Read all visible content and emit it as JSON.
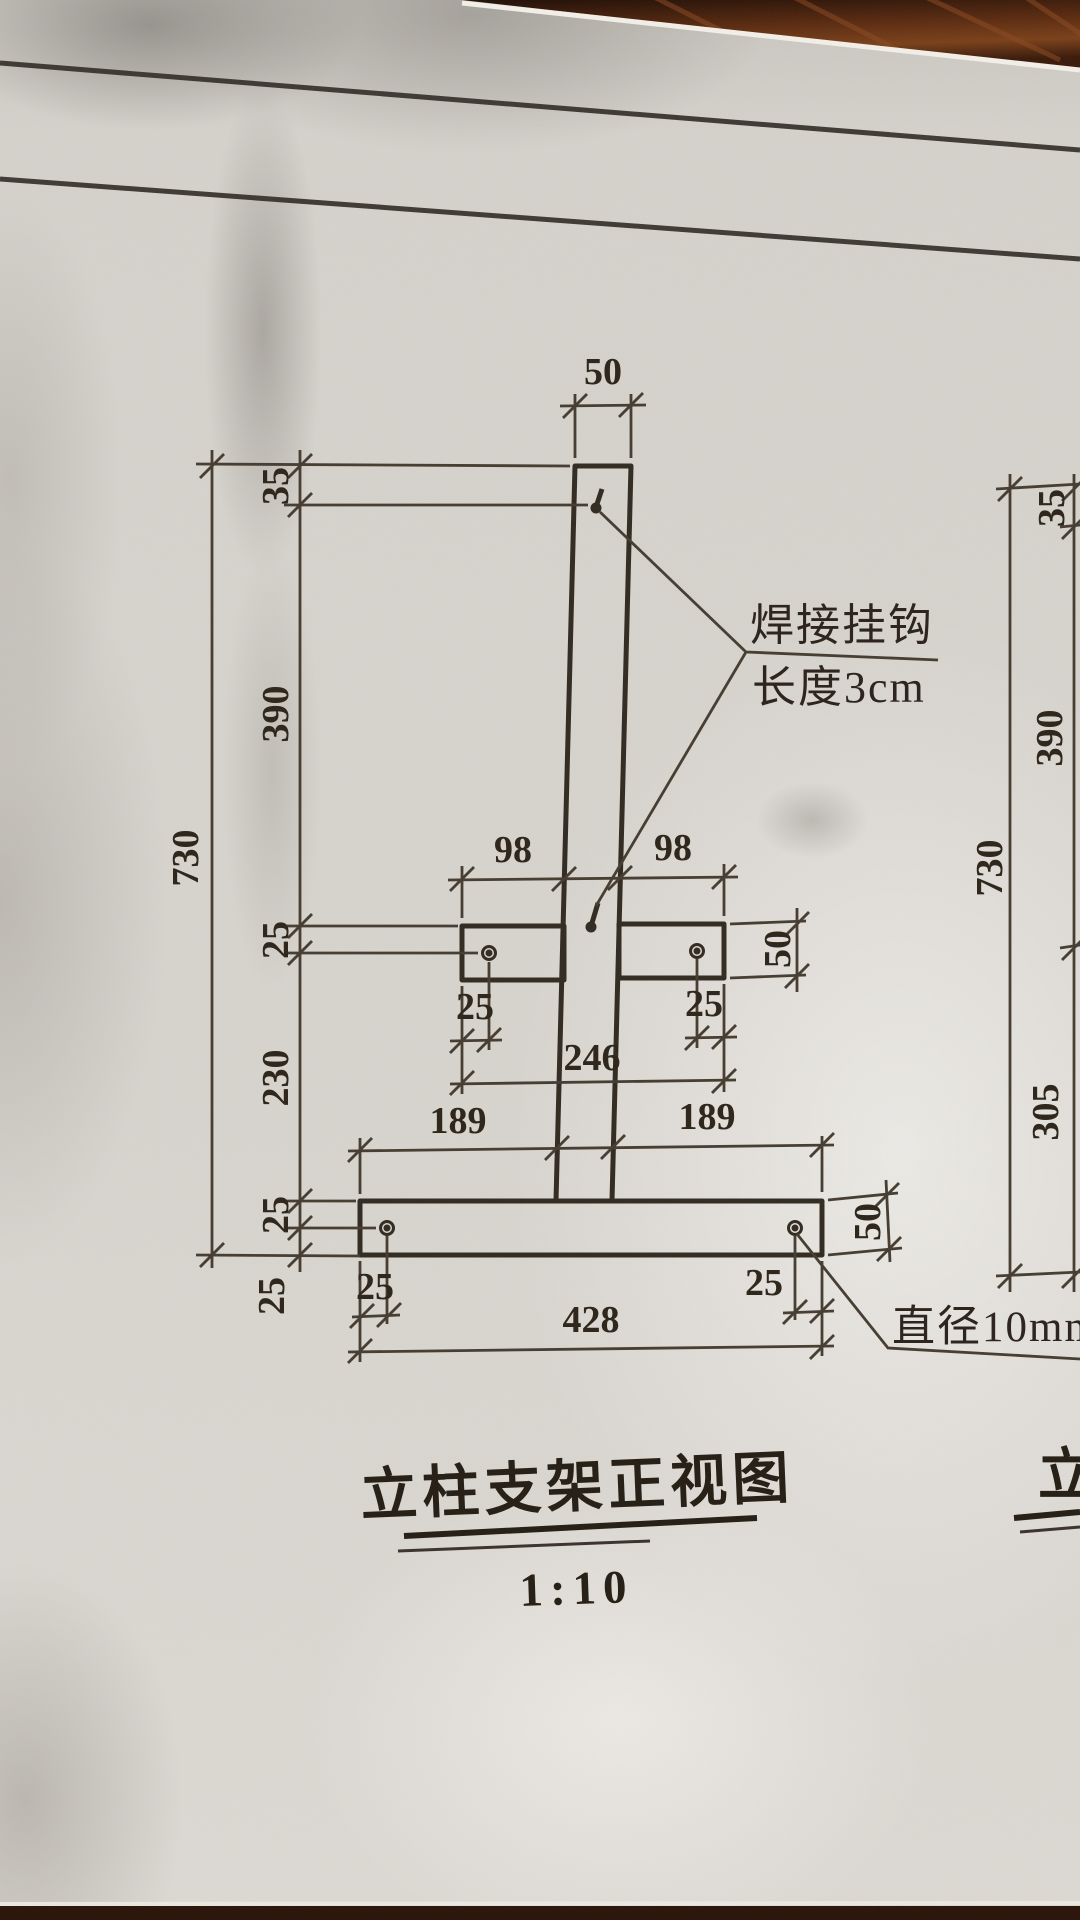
{
  "front_view": {
    "title": "立柱支架正视图",
    "scale_label": "1:10",
    "hook_note_line1": "焊接挂钩",
    "hook_note_line2": "长度3cm",
    "hole_note": "直径10mm钻孔",
    "dims": {
      "top_width": "50",
      "overall_height": "730",
      "seg_top_offset": "35",
      "seg_upper": "390",
      "seg_crossbar_hole": "25",
      "seg_middle": "230",
      "seg_base_hole": "25",
      "seg_base_bottom": "25",
      "crossbar_arm_left": "98",
      "crossbar_arm_right": "98",
      "crossbar_hole_edge_left": "25",
      "crossbar_hole_edge_right": "25",
      "crossbar_total": "246",
      "crossbar_height": "50",
      "base_arm_left": "189",
      "base_arm_right": "189",
      "base_hole_edge_left": "25",
      "base_hole_edge_right": "25",
      "base_total": "428",
      "base_height": "50"
    }
  },
  "side_view": {
    "partial_title": "立",
    "dims": {
      "top_offset": "35",
      "upper": "390",
      "overall": "730",
      "lower": "305"
    }
  }
}
